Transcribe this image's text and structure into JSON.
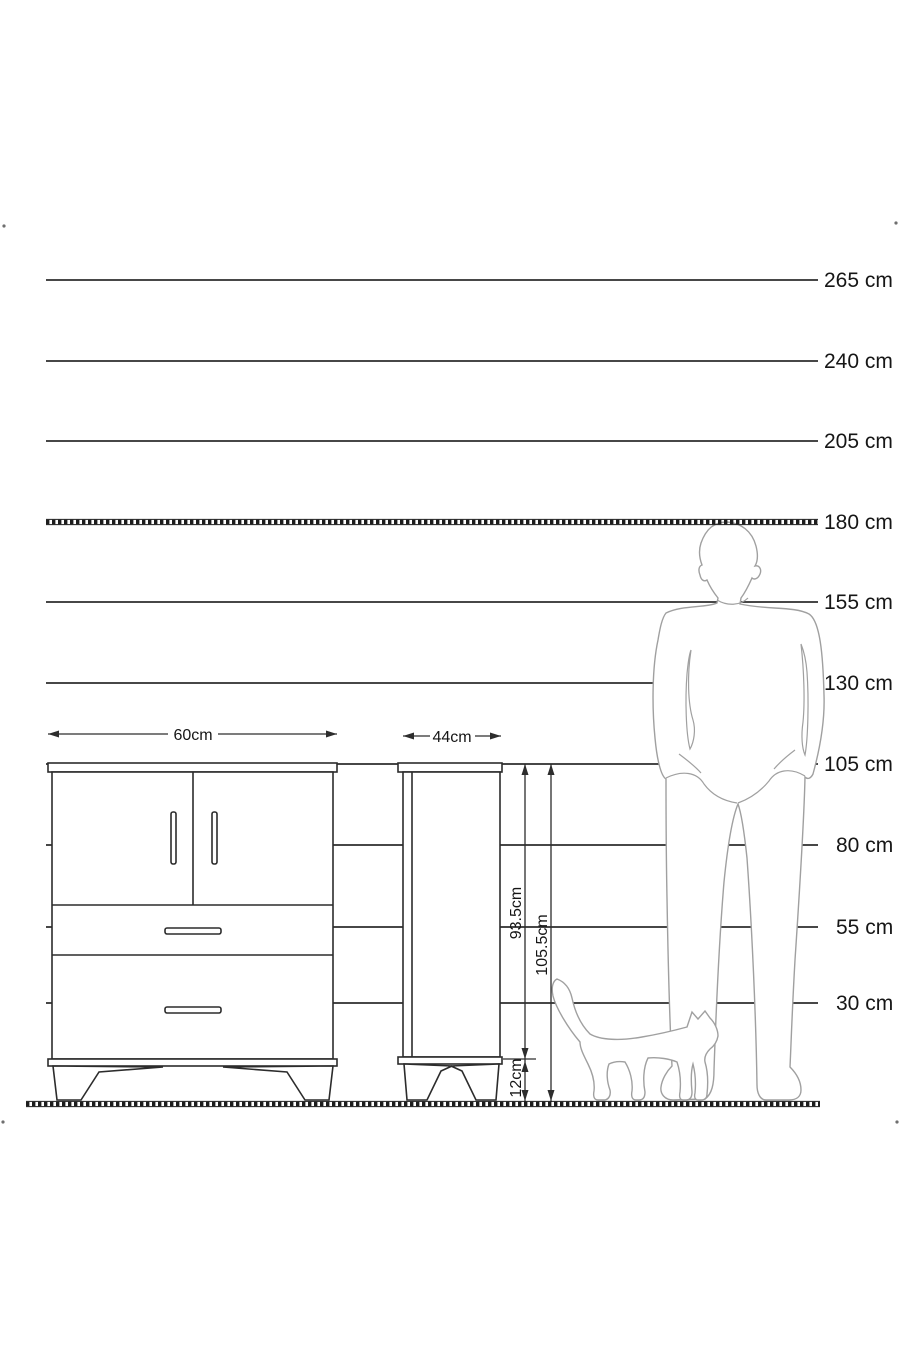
{
  "scale": {
    "unit_lines": [
      {
        "label": "265 cm"
      },
      {
        "label": "240 cm"
      },
      {
        "label": "205 cm"
      },
      {
        "label": "180 cm"
      },
      {
        "label": "155 cm"
      },
      {
        "label": "130 cm"
      },
      {
        "label": "105 cm"
      },
      {
        "label": "80 cm"
      },
      {
        "label": "55 cm"
      },
      {
        "label": "30 cm"
      }
    ]
  },
  "dimensions": {
    "large_cabinet_width": "60cm",
    "small_cabinet_width": "44cm",
    "small_cabinet_body_height": "93.5cm",
    "small_cabinet_total_height": "105.5cm",
    "small_cabinet_leg_height": "12cm"
  },
  "colors": {
    "background": "#ffffff",
    "drawing_line": "#2d2d2d",
    "silhouette_outline": "#a0a0a0",
    "text": "#161616"
  }
}
